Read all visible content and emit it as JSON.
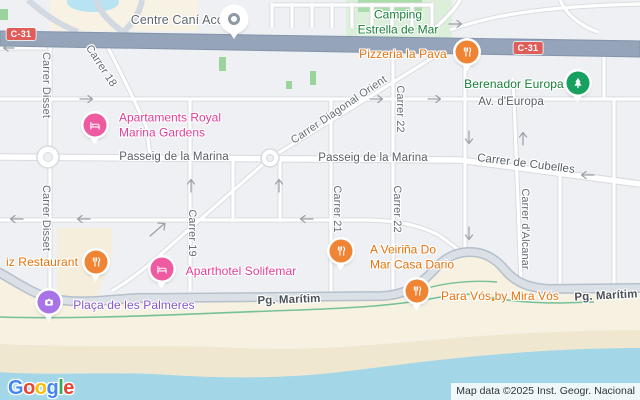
{
  "attribution": "Map data ©2025 Inst. Geogr. Nacional",
  "google_logo": {
    "g1": "G",
    "o1": "o",
    "o2": "o",
    "g2": "g",
    "l1": "l",
    "e1": "e"
  },
  "shields": {
    "c31": "C-31"
  },
  "streets": {
    "passeig_marina": "Passeig de la Marina",
    "av_europa": "Av. d'Europa",
    "pg_maritim": "Pg. Marítim",
    "carrer_disset": "Carrer Disset",
    "carrer_18": "Carrer 18",
    "carrer_19": "Carrer 19",
    "carrer_21": "Carrer 21",
    "carrer_22": "Carrer 22",
    "carrer_diagonal_orient": "Carrer Diagonal Orient",
    "carrer_de_cubelles": "Carrer de Cubelles",
    "carrer_dalcanar": "Carrer d'Alcanar"
  },
  "pois": {
    "centre_cani": {
      "label": "Centre Caní Acc",
      "icon": "generic-dot"
    },
    "camping": {
      "line1": "Camping",
      "line2": "Estrella de Mar"
    },
    "pizzeria": {
      "label": "Pizzeria la Pava",
      "icon": "fork-knife"
    },
    "berenador": {
      "label": "Berenador Europa",
      "icon": "tree"
    },
    "apartaments": {
      "line1": "Apartaments Royal",
      "line2": "Marina Gardens",
      "icon": "bed"
    },
    "veirina": {
      "line1": "A Veiriña Do",
      "line2": "Mar Casa Dario",
      "icon": "fork-knife"
    },
    "iz_restaurant": {
      "label": "iz Restaurant",
      "icon": "fork-knife"
    },
    "aparthotel": {
      "label": "Aparthotel Solifemar",
      "icon": "bed"
    },
    "para_vos": {
      "label": "Para Vós by Mira Vós",
      "icon": "fork-knife"
    },
    "palmeres": {
      "label": "Plaça de les Palmeres",
      "icon": "camera"
    }
  },
  "colors": {
    "restaurant_pin": "#ef8435",
    "restaurant_text": "#e8710a",
    "lodging_pin": "#ef5ba1",
    "lodging_text": "#e23d98",
    "park_pin": "#17a05e",
    "park_text": "#188038",
    "attraction_pin": "#a873e6",
    "attraction_text": "#8355cc",
    "shield_red": "#e15d5a",
    "highway": "#95a4b9",
    "water": "#a3d7e8",
    "sand": "#f7f1e2",
    "land": "#eef0f3"
  }
}
